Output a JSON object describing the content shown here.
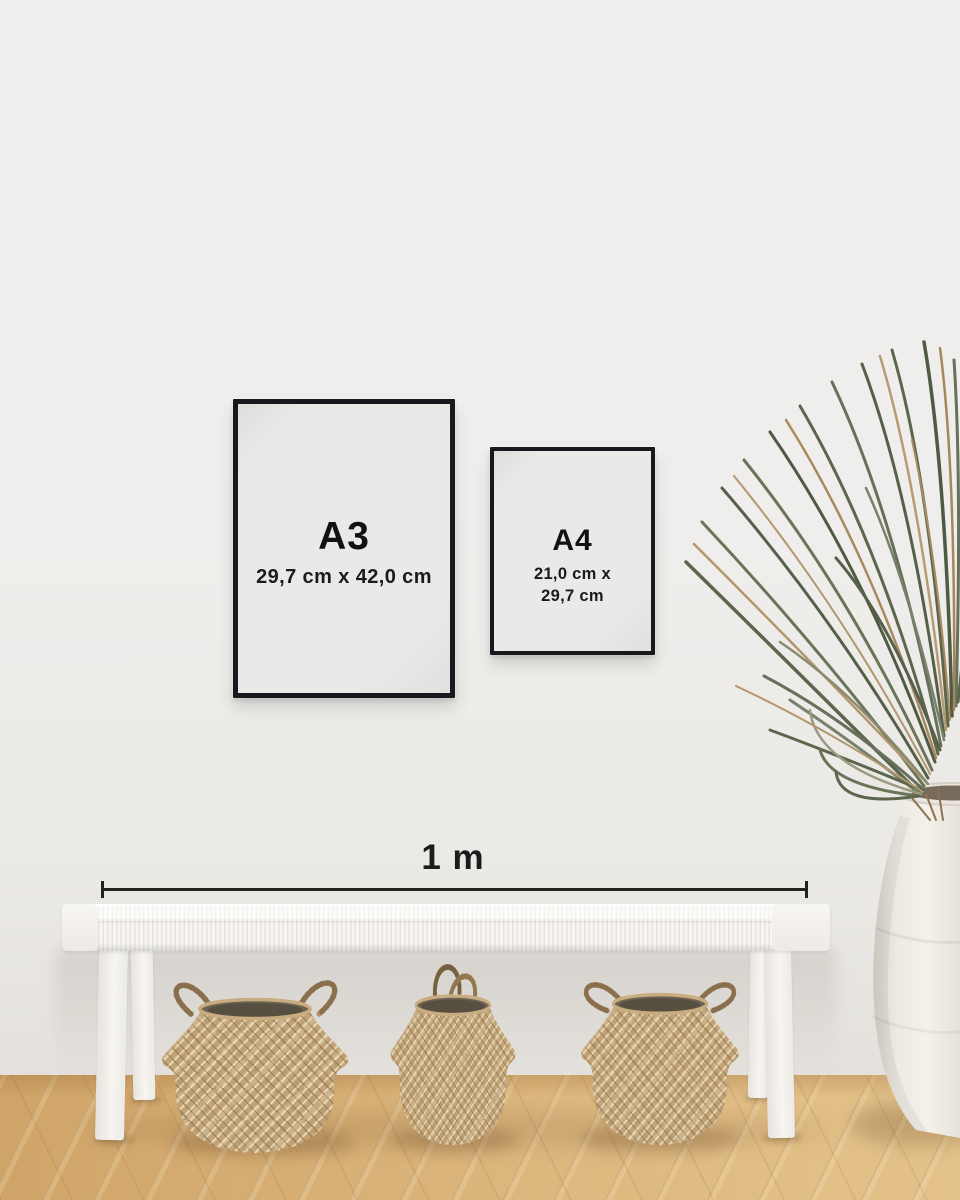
{
  "scene": {
    "type": "frame size guide mockup",
    "frames": {
      "a3": {
        "label": "A3",
        "dimensions": "29,7 cm x 42,0 cm"
      },
      "a4": {
        "label": "A4",
        "dimensions_line1": "21,0 cm x",
        "dimensions_line2": "29,7 cm"
      }
    },
    "scale_bar": {
      "label": "1 m"
    },
    "colors": {
      "wall": "#efeeec",
      "frame_border": "#17191d",
      "text": "#161616",
      "floor_wood": "#d4ac72",
      "basket_weave": "#c2a377",
      "bench": "#f4f2ee",
      "vase": "#efebe4",
      "plant_green": "#5c664d",
      "plant_tan": "#ab8c61"
    },
    "objects": [
      "black framed print A3",
      "black framed print A4",
      "horizontal scale bar 1 m",
      "white woven bench",
      "three seagrass belly baskets",
      "dried palm plant",
      "white ceramic floor vase",
      "herringbone wood floor"
    ]
  }
}
